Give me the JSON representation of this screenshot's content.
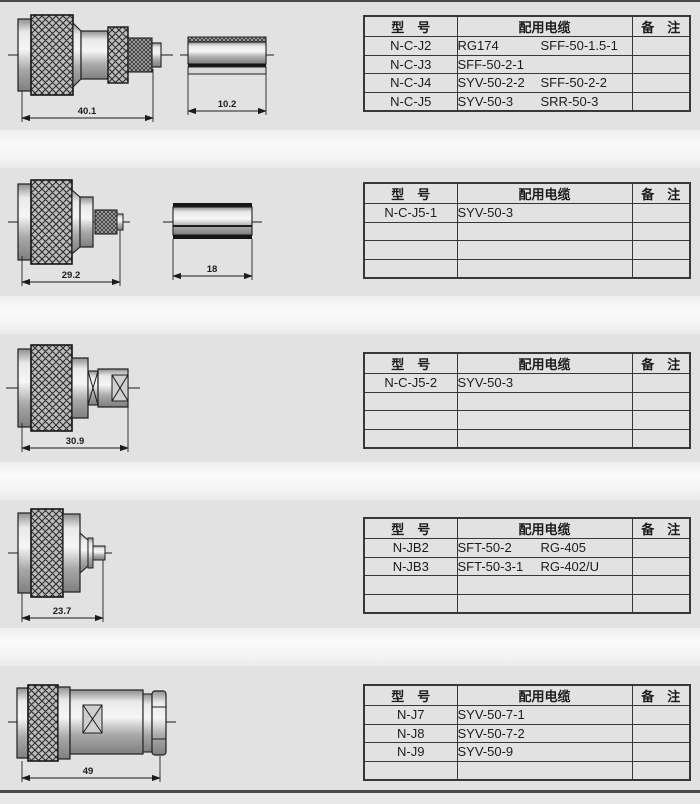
{
  "colors": {
    "band_bg": "#e2e2e2",
    "gap_bg": "#f7f7f7",
    "table_border": "#383838",
    "page_rule": "#4a4a4a",
    "text": "#1c1c1c"
  },
  "headers": {
    "model": "型　号",
    "cable": "配用电缆",
    "remark": "备　注"
  },
  "sections": [
    {
      "dimension": "40.1",
      "ferrule_dimension": "10.2",
      "rows": [
        {
          "model": "N-C-J2",
          "cables": [
            "RG174",
            "SFF-50-1.5-1"
          ]
        },
        {
          "model": "N-C-J3",
          "cables": [
            "SFF-50-2-1"
          ]
        },
        {
          "model": "N-C-J4",
          "cables": [
            "SYV-50-2-2",
            "SFF-50-2-2"
          ]
        },
        {
          "model": "N-C-J5",
          "cables": [
            "SYV-50-3",
            "SRR-50-3"
          ]
        }
      ]
    },
    {
      "dimension": "29.2",
      "ferrule_dimension": "18",
      "rows": [
        {
          "model": "N-C-J5-1",
          "cables": [
            "SYV-50-3"
          ]
        },
        {
          "model": "",
          "cables": []
        },
        {
          "model": "",
          "cables": []
        },
        {
          "model": "",
          "cables": []
        }
      ]
    },
    {
      "dimension": "30.9",
      "rows": [
        {
          "model": "N-C-J5-2",
          "cables": [
            "SYV-50-3"
          ]
        },
        {
          "model": "",
          "cables": []
        },
        {
          "model": "",
          "cables": []
        },
        {
          "model": "",
          "cables": []
        }
      ]
    },
    {
      "dimension": "23.7",
      "rows": [
        {
          "model": "N-JB2",
          "cables": [
            "SFT-50-2",
            "RG-405"
          ]
        },
        {
          "model": "N-JB3",
          "cables": [
            "SFT-50-3-1",
            "RG-402/U"
          ]
        },
        {
          "model": "",
          "cables": []
        },
        {
          "model": "",
          "cables": []
        }
      ]
    },
    {
      "dimension": "49",
      "rows": [
        {
          "model": "N-J7",
          "cables": [
            "SYV-50-7-1"
          ]
        },
        {
          "model": "N-J8",
          "cables": [
            "SYV-50-7-2"
          ]
        },
        {
          "model": "N-J9",
          "cables": [
            "SYV-50-9"
          ]
        },
        {
          "model": "",
          "cables": []
        }
      ]
    }
  ]
}
